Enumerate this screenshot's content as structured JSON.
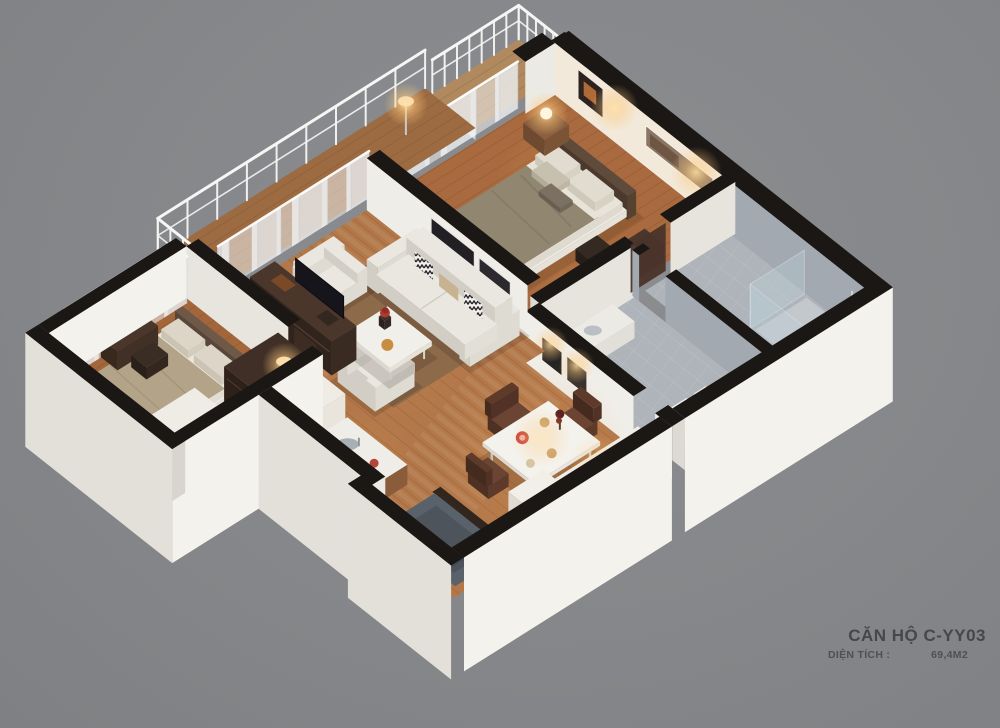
{
  "caption": {
    "title": "CĂN HỘ C-YY03",
    "area_label": "DIỆN TÍCH :",
    "area_value": "69,4M2"
  },
  "colors": {
    "background": "#85878a",
    "wall_top": "#1b1715",
    "wall_face_south": "#e3e0da",
    "wall_face_east": "#f4f2ed",
    "wall_inner_warm": "#f2e9da",
    "wood_living": "#b3784a",
    "wood_bedroom": "#a86a3e",
    "wood_balcony": "#b08a5e",
    "tile_floor": "#aeb4b9",
    "tile_wall": "#a2a9b0",
    "glass": "#bdd0da",
    "railing": "#f6f6f4",
    "curtain": "#eef0f3",
    "sofa": "#eae7e0",
    "sofa_shade": "#d2cec5",
    "bed_taupe": "#91866f",
    "bed_beige": "#b3a489",
    "pillow_light": "#e1dccf",
    "cabinet_dark": "#413025",
    "counter_wood": "#7d5236",
    "rug": "#9a7451",
    "entry_mat": "#59616a",
    "accent_red": "#c9463a",
    "glow_warm": "#ffc97d",
    "caption_text": "#46484c"
  }
}
